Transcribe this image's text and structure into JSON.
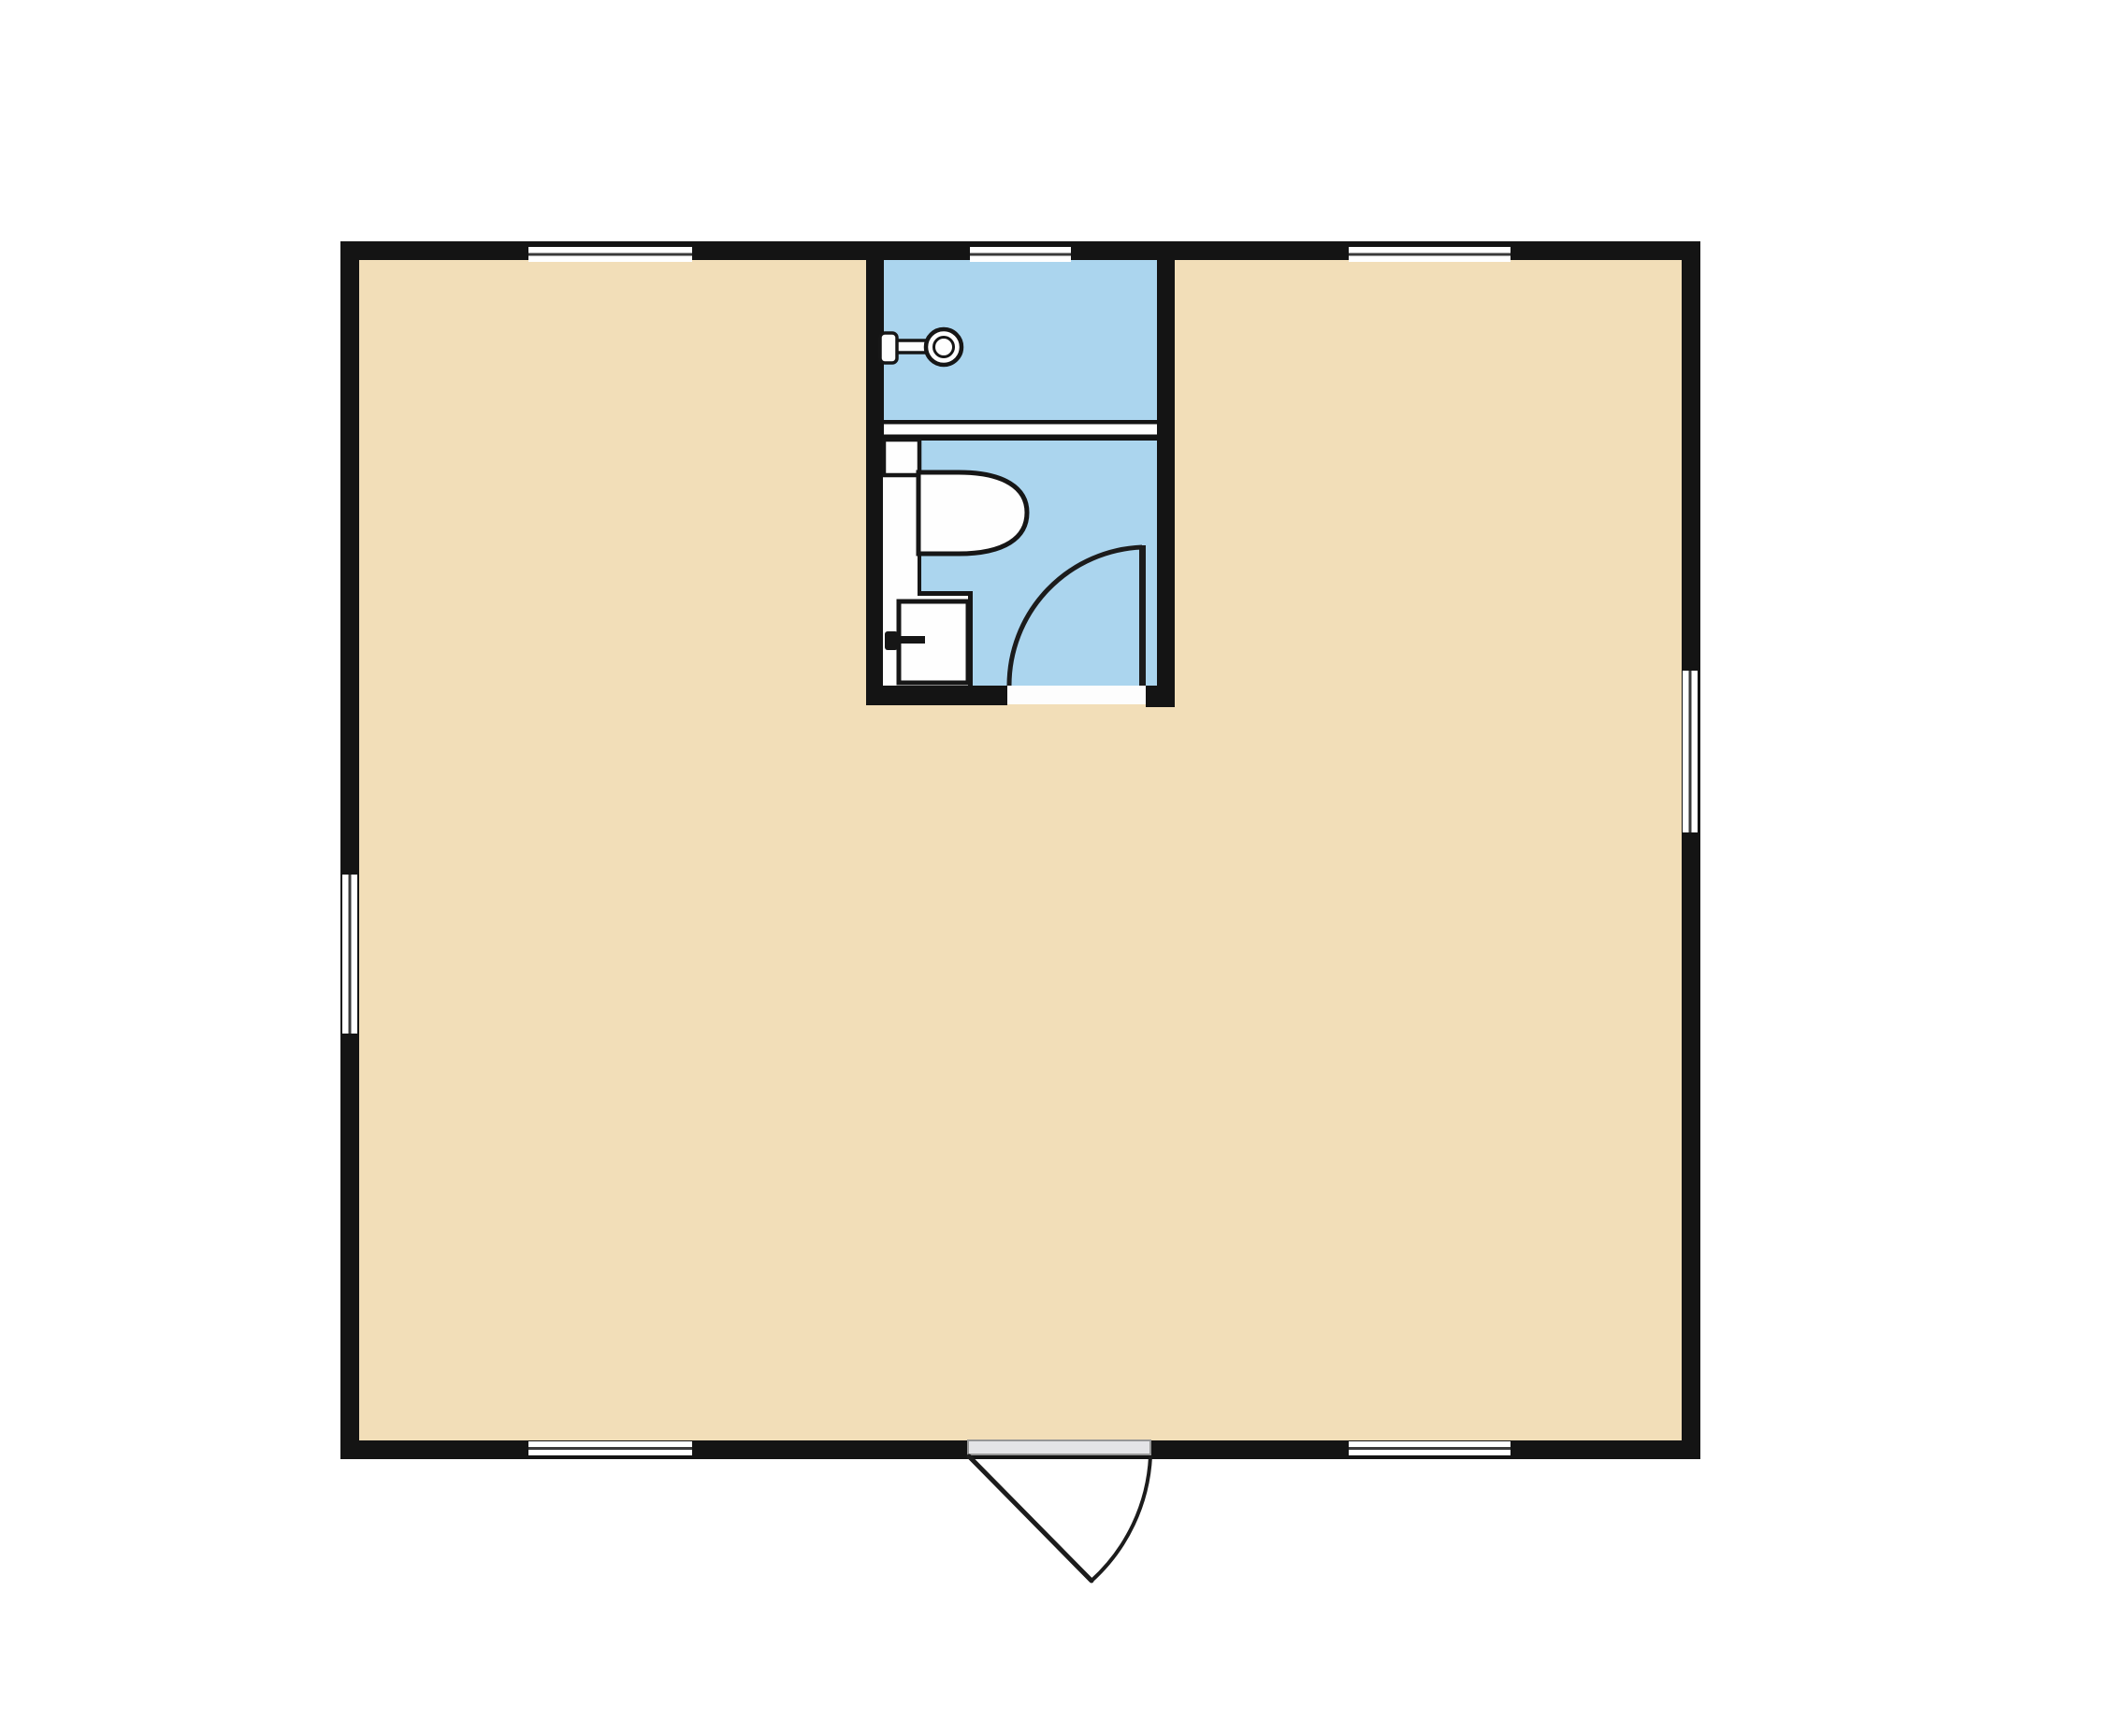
{
  "page": {
    "background": "#ffffff",
    "kind": "architectural floor plan"
  },
  "colors": {
    "wall": "#141414",
    "floor": "#f2deb8",
    "bathroom_floor": "#abd5ee",
    "fixture_fill": "#fefefe",
    "fixture_outline": "#161616",
    "window_glass": "#ffffff",
    "window_mullion": "#3a3a3a",
    "partition_gap": "#ffffff",
    "threshold": "#fdfdfd",
    "door_slab": "#e4e4e7",
    "door_slab_border": "#979797",
    "swing_line": "#1c1c1c"
  },
  "plan": {
    "rooms": [
      {
        "name": "main-room",
        "type": "open room",
        "floor_color": "#f2deb8"
      },
      {
        "name": "bathroom",
        "type": "bathroom",
        "floor_color": "#abd5ee",
        "fixtures": [
          "shower-head",
          "toilet",
          "vanity-counter",
          "sink"
        ]
      }
    ],
    "windows": [
      {
        "wall": "top",
        "position": "left"
      },
      {
        "wall": "top",
        "position": "middle"
      },
      {
        "wall": "top",
        "position": "right"
      },
      {
        "wall": "bottom",
        "position": "left"
      },
      {
        "wall": "bottom",
        "position": "right"
      },
      {
        "wall": "left",
        "position": "middle"
      },
      {
        "wall": "right",
        "position": "upper-middle"
      }
    ],
    "doors": [
      {
        "name": "entry-door",
        "wall": "bottom",
        "swing": "outward, hinged left"
      },
      {
        "name": "bathroom-door",
        "wall": "bathroom-bottom",
        "swing": "inward, hinged right"
      }
    ]
  }
}
